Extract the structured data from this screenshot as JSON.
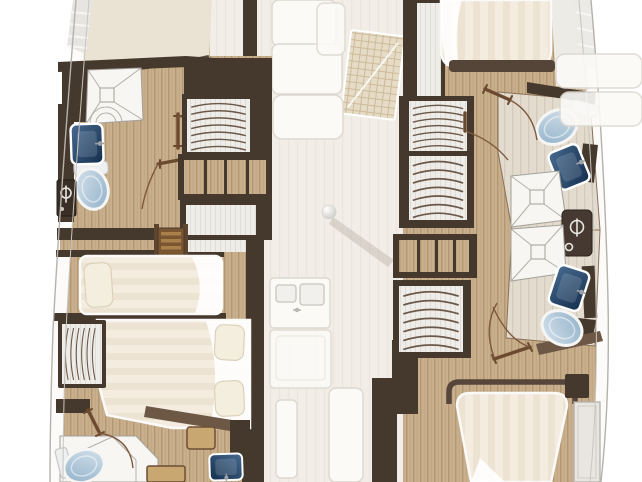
{
  "meta": {
    "type": "floorplan",
    "subject": "catamaran lower deck layout, ghosted saloon between hulls"
  },
  "colors": {
    "wood": "#c9af8c",
    "wood_line": "#b19773",
    "tile": "#e2dbce",
    "tile_line": "#d3cabb",
    "ghost_floor": "#f2eee7",
    "ghost_line": "#ebe6dd",
    "ghost_white": "#fbfaf7",
    "ghost_stroke": "#dcd8d0",
    "panel": "#efedea",
    "panel_line": "#e0ddd7",
    "wall_dark": "#45382d",
    "wall_mid": "#6d5846",
    "frame_brown": "#5a4636",
    "door_brown": "#6b4a30",
    "arc_brown": "#7d5a3e",
    "hanger": "#6a5848",
    "bed_stripe_a": "#ece3d2",
    "bed_stripe_b": "#f3ecdf",
    "pillow": "#f4eedf",
    "pillow_line": "#dcd1ba",
    "white_fixture": "#f7f6f3",
    "fixture_line": "#a3a09a",
    "toilet_light": "#d7e3ed",
    "toilet_dark": "#8fb0c8",
    "sink_light": "#476b90",
    "sink_dark": "#142e4d",
    "stair_light": "#a97f4a",
    "stair_dark": "#7a5531",
    "bench_tan": "#c9a771",
    "hull_line": "#b5b2ac",
    "hull_inner_line": "#c9c5bf",
    "cream_deck": "#eae2d2",
    "grid_base": "#e6dcc6",
    "grid_line": "#ccba9b"
  },
  "plan": {
    "port_hull": {
      "forward_head": [
        "shower",
        "washbasin",
        "toilet",
        "shower-column-cabinet",
        "cistern"
      ],
      "storage": [
        "hanging-locker",
        "shelf-unit",
        "locker"
      ],
      "companionway": [
        "steps"
      ],
      "cabins": [
        "single-berth",
        "double-berth"
      ],
      "aft_head": [
        "shower-pan",
        "toilet",
        "washbasin",
        "bench",
        "ottoman"
      ]
    },
    "starboard_hull": {
      "forward_cabin": [
        "double-berth"
      ],
      "storage": [
        "locker-band",
        "hanging-locker",
        "hanging-locker",
        "shelf-unit",
        "hanging-locker"
      ],
      "forward_head": [
        "toilet",
        "washbasin",
        "shower"
      ],
      "between_heads": [
        "shower-column-panel"
      ],
      "aft_head": [
        "shower",
        "washbasin",
        "toilet"
      ],
      "aft_cabin": [
        "double-berth",
        "side-steps"
      ]
    },
    "saloon_ghosted": [
      "settee",
      "settee",
      "chart-table",
      "galley-double-sink",
      "galley-counter",
      "mast-step",
      "cockpit-bench",
      "cockpit-bench",
      "side-deck-bands"
    ]
  }
}
